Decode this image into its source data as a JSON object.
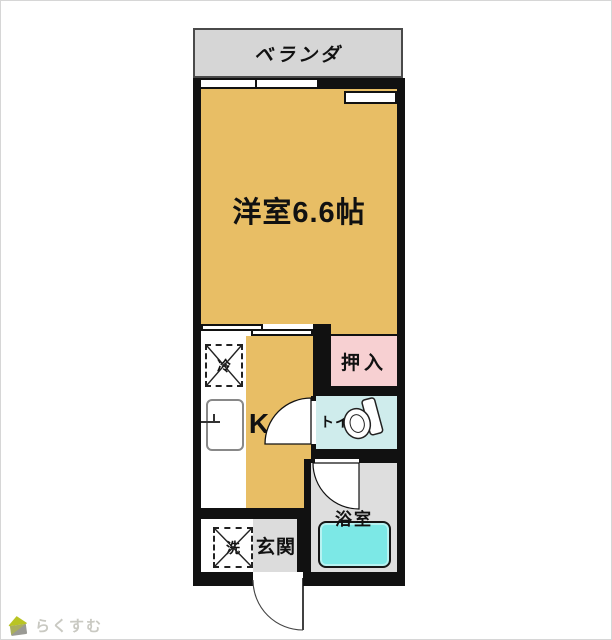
{
  "rooms": {
    "veranda": {
      "label": "ベランダ",
      "color": "#d6d6d6"
    },
    "main_room": {
      "label": "洋室6.6帖",
      "color": "#e8be65"
    },
    "kitchen": {
      "label": "K",
      "color": "#e8be65"
    },
    "closet": {
      "label": "押入",
      "color": "#f7d0d2"
    },
    "toilet": {
      "label": "トイレ",
      "color": "#cfecec"
    },
    "bathroom": {
      "label": "浴室",
      "color": "#dedede",
      "bathtub_color": "#7ce8e6"
    },
    "entrance": {
      "label": "玄関",
      "color": "#dcdcdc"
    }
  },
  "fixtures": {
    "refrigerator": {
      "label": "冷"
    },
    "washer": {
      "label": "洗"
    }
  },
  "icons": {
    "toilet_icon": "toilet-icon",
    "bathtub_icon": "bathtub-icon",
    "sink_icon": "kitchen-sink-icon",
    "door_swing_icons": "door-swing-icon",
    "sliding_door_icon": "sliding-door-icon",
    "window_icon": "window-icon",
    "house_icon": "house-icon"
  },
  "walls": {
    "color": "#111111"
  },
  "watermark": {
    "brand": "らくすむ"
  }
}
